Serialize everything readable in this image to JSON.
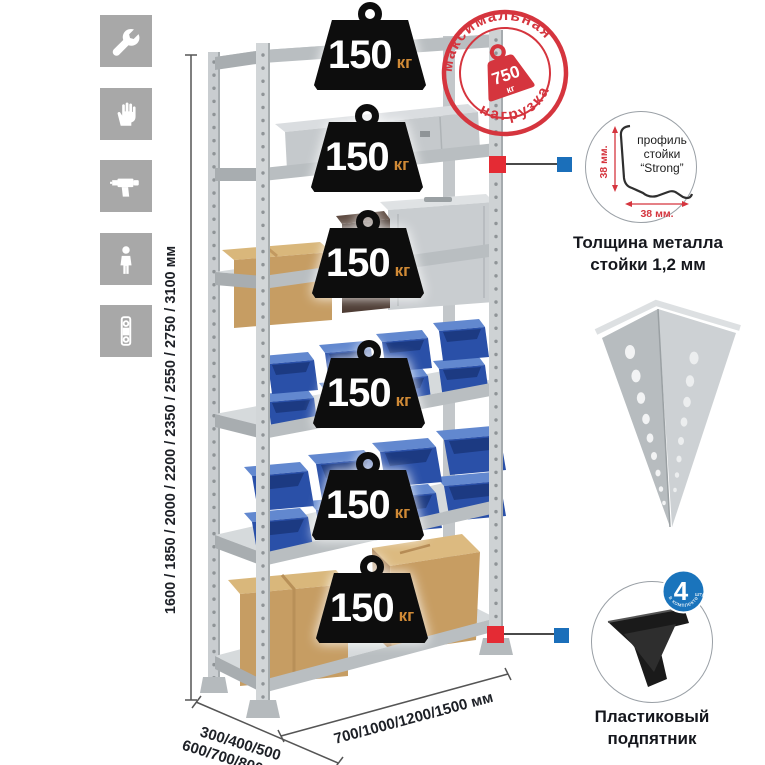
{
  "page": {
    "background": "#ffffff"
  },
  "assembly_icons": [
    {
      "name": "wrench-icon"
    },
    {
      "name": "gloves-icon"
    },
    {
      "name": "drill-icon"
    },
    {
      "name": "person-icon"
    },
    {
      "name": "level-icon"
    }
  ],
  "dimensions": {
    "height": "1600 / 1850 / 2000 / 2200 / 2350 / 2550 / 2750 / 3100 мм",
    "depth_line1": "300/400/500",
    "depth_line2": "600/700/800 мм",
    "width": "700/1000/1200/1500 мм"
  },
  "max_load": {
    "arc_top": "максимальная",
    "arc_bottom": "нагрузка",
    "value": "750",
    "unit": "кг"
  },
  "shelves": {
    "count": 6,
    "load_value": "150",
    "load_unit": "кг"
  },
  "profile_detail": {
    "label_line1": "профиль",
    "label_line2": "стойки",
    "label_line3": "“Strong”",
    "dim_vertical": "38 мм.",
    "dim_horizontal": "38 мм.",
    "caption_line1": "Толщина металла",
    "caption_line2": "стойки 1,2 мм"
  },
  "foot_detail": {
    "badge_value": "4",
    "badge_small": "штуки",
    "badge_arc": "в комплекте",
    "caption_line1": "Пластиковый",
    "caption_line2": "подпятник"
  },
  "colors": {
    "stamp_red": "#d5353e",
    "callout_red": "#e42b34",
    "callout_blue": "#1b6fba",
    "weight_black": "#0d0d0d",
    "weight_unit_orange": "#d08a36",
    "metal_light": "#cdd1d3",
    "bin_blue": "#2a50a8",
    "cardboard": "#c69d63",
    "icon_gray": "#a8a8a8"
  }
}
